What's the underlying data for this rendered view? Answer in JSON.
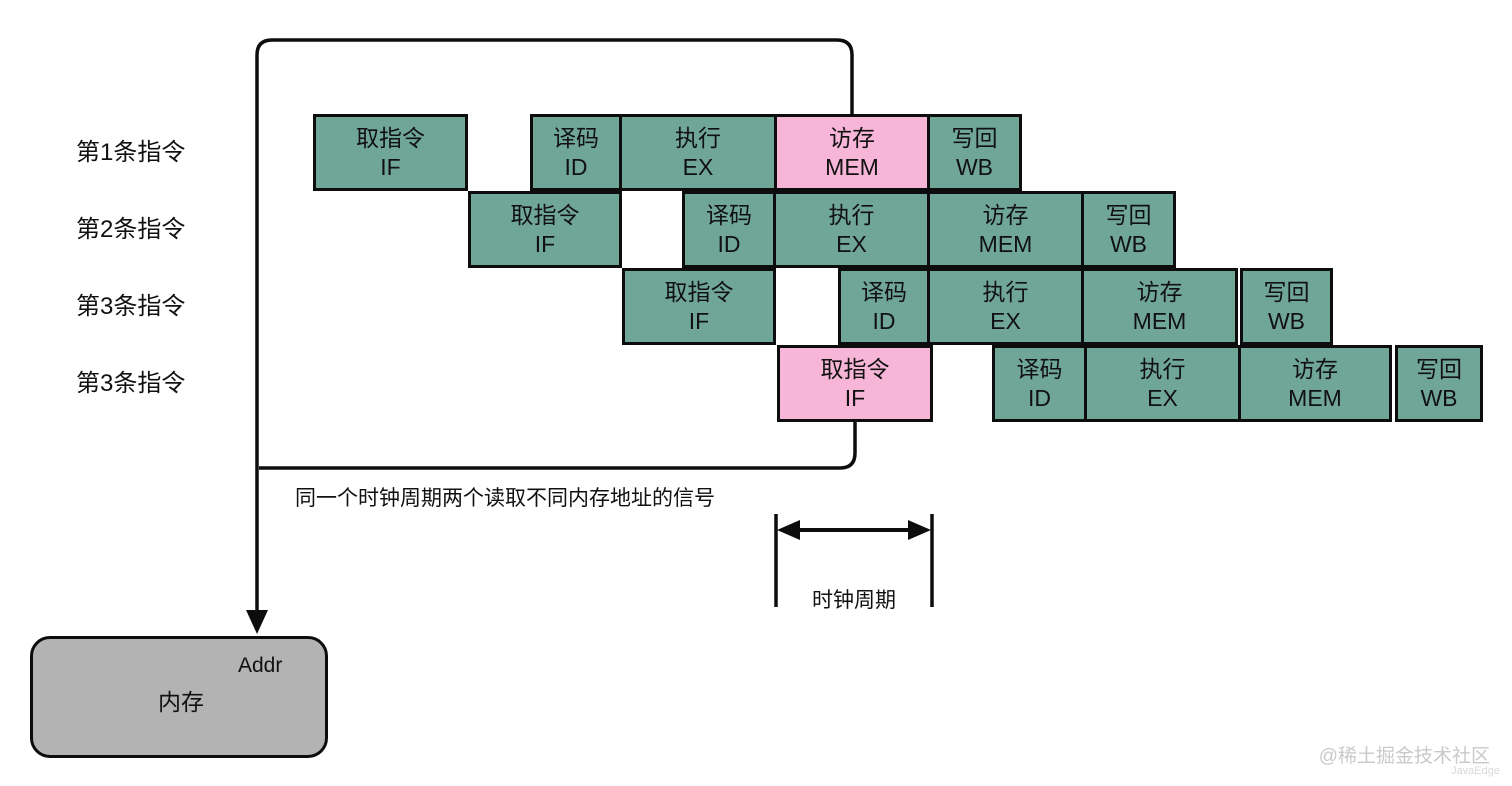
{
  "diagram": {
    "title_hint": "CPU five-stage pipeline structural hazard diagram",
    "colors": {
      "teal": "#6FA697",
      "pink": "#F7B6D7",
      "memory_gray": "#B3B3B3",
      "line": "#0d0d0d",
      "background": "#ffffff"
    },
    "row_labels": [
      "第1条指令",
      "第2条指令",
      "第3条指令",
      "第3条指令"
    ],
    "stage_legend": {
      "IF": "取指令",
      "ID": "译码",
      "EX": "执行",
      "MEM": "访存",
      "WB": "写回"
    },
    "rows": [
      {
        "y": 114,
        "cells": [
          {
            "x": 313,
            "w": 155,
            "color": "teal",
            "name": "取指令",
            "abbr": "IF"
          },
          {
            "x": 530,
            "w": 92,
            "color": "teal",
            "name": "译码",
            "abbr": "ID"
          },
          {
            "x": 619,
            "w": 158,
            "color": "teal",
            "name": "执行",
            "abbr": "EX"
          },
          {
            "x": 774,
            "w": 156,
            "color": "pink",
            "name": "访存",
            "abbr": "MEM"
          },
          {
            "x": 927,
            "w": 95,
            "color": "teal",
            "name": "写回",
            "abbr": "WB"
          }
        ]
      },
      {
        "y": 191,
        "cells": [
          {
            "x": 468,
            "w": 154,
            "color": "teal",
            "name": "取指令",
            "abbr": "IF"
          },
          {
            "x": 682,
            "w": 94,
            "color": "teal",
            "name": "译码",
            "abbr": "ID"
          },
          {
            "x": 773,
            "w": 157,
            "color": "teal",
            "name": "执行",
            "abbr": "EX"
          },
          {
            "x": 927,
            "w": 157,
            "color": "teal",
            "name": "访存",
            "abbr": "MEM"
          },
          {
            "x": 1081,
            "w": 95,
            "color": "teal",
            "name": "写回",
            "abbr": "WB"
          }
        ]
      },
      {
        "y": 268,
        "cells": [
          {
            "x": 622,
            "w": 154,
            "color": "teal",
            "name": "取指令",
            "abbr": "IF"
          },
          {
            "x": 838,
            "w": 92,
            "color": "teal",
            "name": "译码",
            "abbr": "ID"
          },
          {
            "x": 927,
            "w": 157,
            "color": "teal",
            "name": "执行",
            "abbr": "EX"
          },
          {
            "x": 1081,
            "w": 157,
            "color": "teal",
            "name": "访存",
            "abbr": "MEM"
          },
          {
            "x": 1240,
            "w": 93,
            "color": "teal",
            "name": "写回",
            "abbr": "WB"
          }
        ]
      },
      {
        "y": 345,
        "cells": [
          {
            "x": 777,
            "w": 156,
            "color": "pink",
            "name": "取指令",
            "abbr": "IF"
          },
          {
            "x": 992,
            "w": 95,
            "color": "teal",
            "name": "译码",
            "abbr": "ID"
          },
          {
            "x": 1084,
            "w": 157,
            "color": "teal",
            "name": "执行",
            "abbr": "EX"
          },
          {
            "x": 1238,
            "w": 154,
            "color": "teal",
            "name": "访存",
            "abbr": "MEM"
          },
          {
            "x": 1395,
            "w": 88,
            "color": "teal",
            "name": "写回",
            "abbr": "WB"
          }
        ]
      }
    ],
    "annotation": "同一个时钟周期两个读取不同内存地址的信号",
    "clock_label": "时钟周期",
    "memory": {
      "label": "内存",
      "port": "Addr"
    },
    "watermark": {
      "line1": "@稀土掘金技术社区",
      "line2": "JavaEdge"
    }
  }
}
